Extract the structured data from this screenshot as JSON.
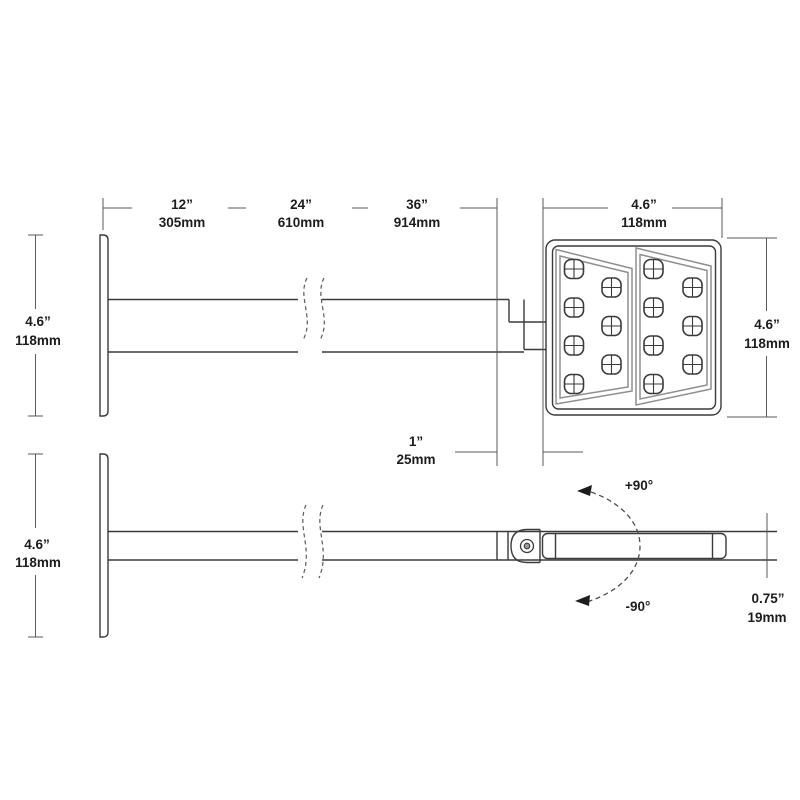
{
  "dimensions": {
    "arm_length_options": [
      {
        "inches": "12”",
        "mm": "305mm"
      },
      {
        "inches": "24”",
        "mm": "610mm"
      },
      {
        "inches": "36”",
        "mm": "914mm"
      }
    ],
    "head_width": {
      "inches": "4.6”",
      "mm": "118mm"
    },
    "head_height": {
      "inches": "4.6”",
      "mm": "118mm"
    },
    "plate_height_front": {
      "inches": "4.6”",
      "mm": "118mm"
    },
    "plate_height_side": {
      "inches": "4.6”",
      "mm": "118mm"
    },
    "arm_to_head_offset": {
      "inches": "1”",
      "mm": "25mm"
    },
    "head_thickness": {
      "inches": "0.75”",
      "mm": "19mm"
    },
    "tilt_up": "+90°",
    "tilt_down": "-90°"
  },
  "colors": {
    "line": "#3a3a3a",
    "dimension_line": "#5a5a5a",
    "panel_outline": "#8f8f8f",
    "background": "#ffffff"
  }
}
